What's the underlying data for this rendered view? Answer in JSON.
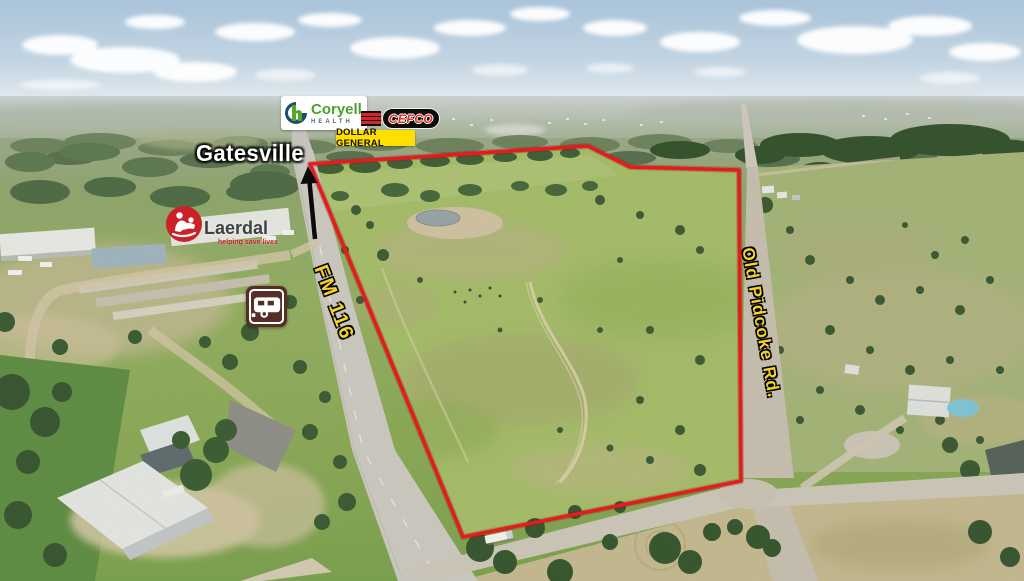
{
  "annotations": {
    "town": "Gatesville",
    "road_left": "FM 116",
    "road_right": "Old Pidcoke Rd."
  },
  "logos": {
    "coryell_health": {
      "monogram": "h",
      "name": "Coryell",
      "sub": "HEALTH"
    },
    "cefco": {
      "name": "CEFCO"
    },
    "dollar_general": {
      "name": "DOLLAR GENERAL"
    },
    "laerdal": {
      "name": "Laerdal",
      "tagline": "helping save lives"
    }
  },
  "icons": {
    "north_arrow": "north-direction-arrow",
    "rv_sign": "rv-campground-sign",
    "laerdal_mark": "laerdal-good-samaritan-icon",
    "coryell_monogram": "coryell-health-monogram",
    "cefco_stripes": "cefco-red-stripes"
  },
  "colors": {
    "boundary_red": "#e11d1d",
    "road_label_yellow": "#f3d32b",
    "dollar_general_yellow": "#ffdf00",
    "cefco_red": "#e22b20",
    "coryell_green": "#4d9f2e",
    "laerdal_red": "#cb222a",
    "rv_sign_brown": "#572e26",
    "sky_blue": "#b4cadd",
    "field_green": "#9db964"
  }
}
